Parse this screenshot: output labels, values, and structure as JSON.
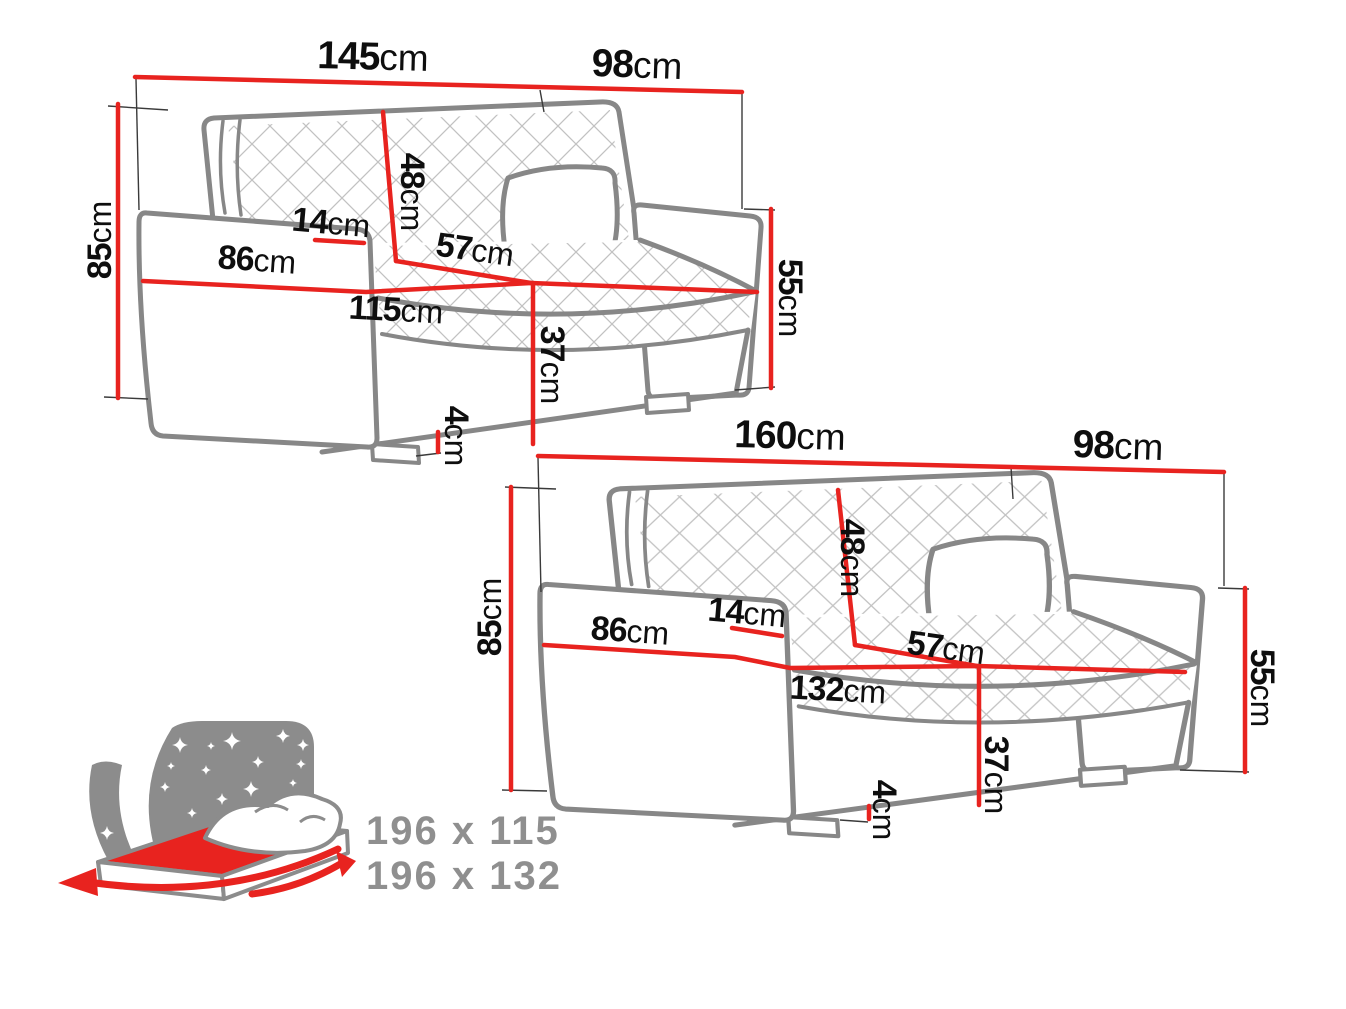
{
  "unit": "cm",
  "dims": {
    "sofa_small": {
      "width": "145",
      "depth": "98",
      "height": "85",
      "backrest": "48",
      "arm_width": "14",
      "arm_depth": "86",
      "seat_depth": "57",
      "seat_width": "115",
      "seat_height": "37",
      "legs": "4",
      "arm_height": "55"
    },
    "sofa_large": {
      "width": "160",
      "depth": "98",
      "height": "85",
      "backrest": "48",
      "arm_width": "14",
      "arm_depth": "86",
      "seat_depth": "57",
      "seat_width": "132",
      "seat_height": "37",
      "legs": "4",
      "arm_height": "55"
    }
  },
  "bed": {
    "sizes": [
      "196 x 115",
      "196 x 132"
    ]
  },
  "colors": {
    "accent_red": "#e8231f",
    "outline_grey": "#878787",
    "text_grey": "#8f8f8f"
  }
}
